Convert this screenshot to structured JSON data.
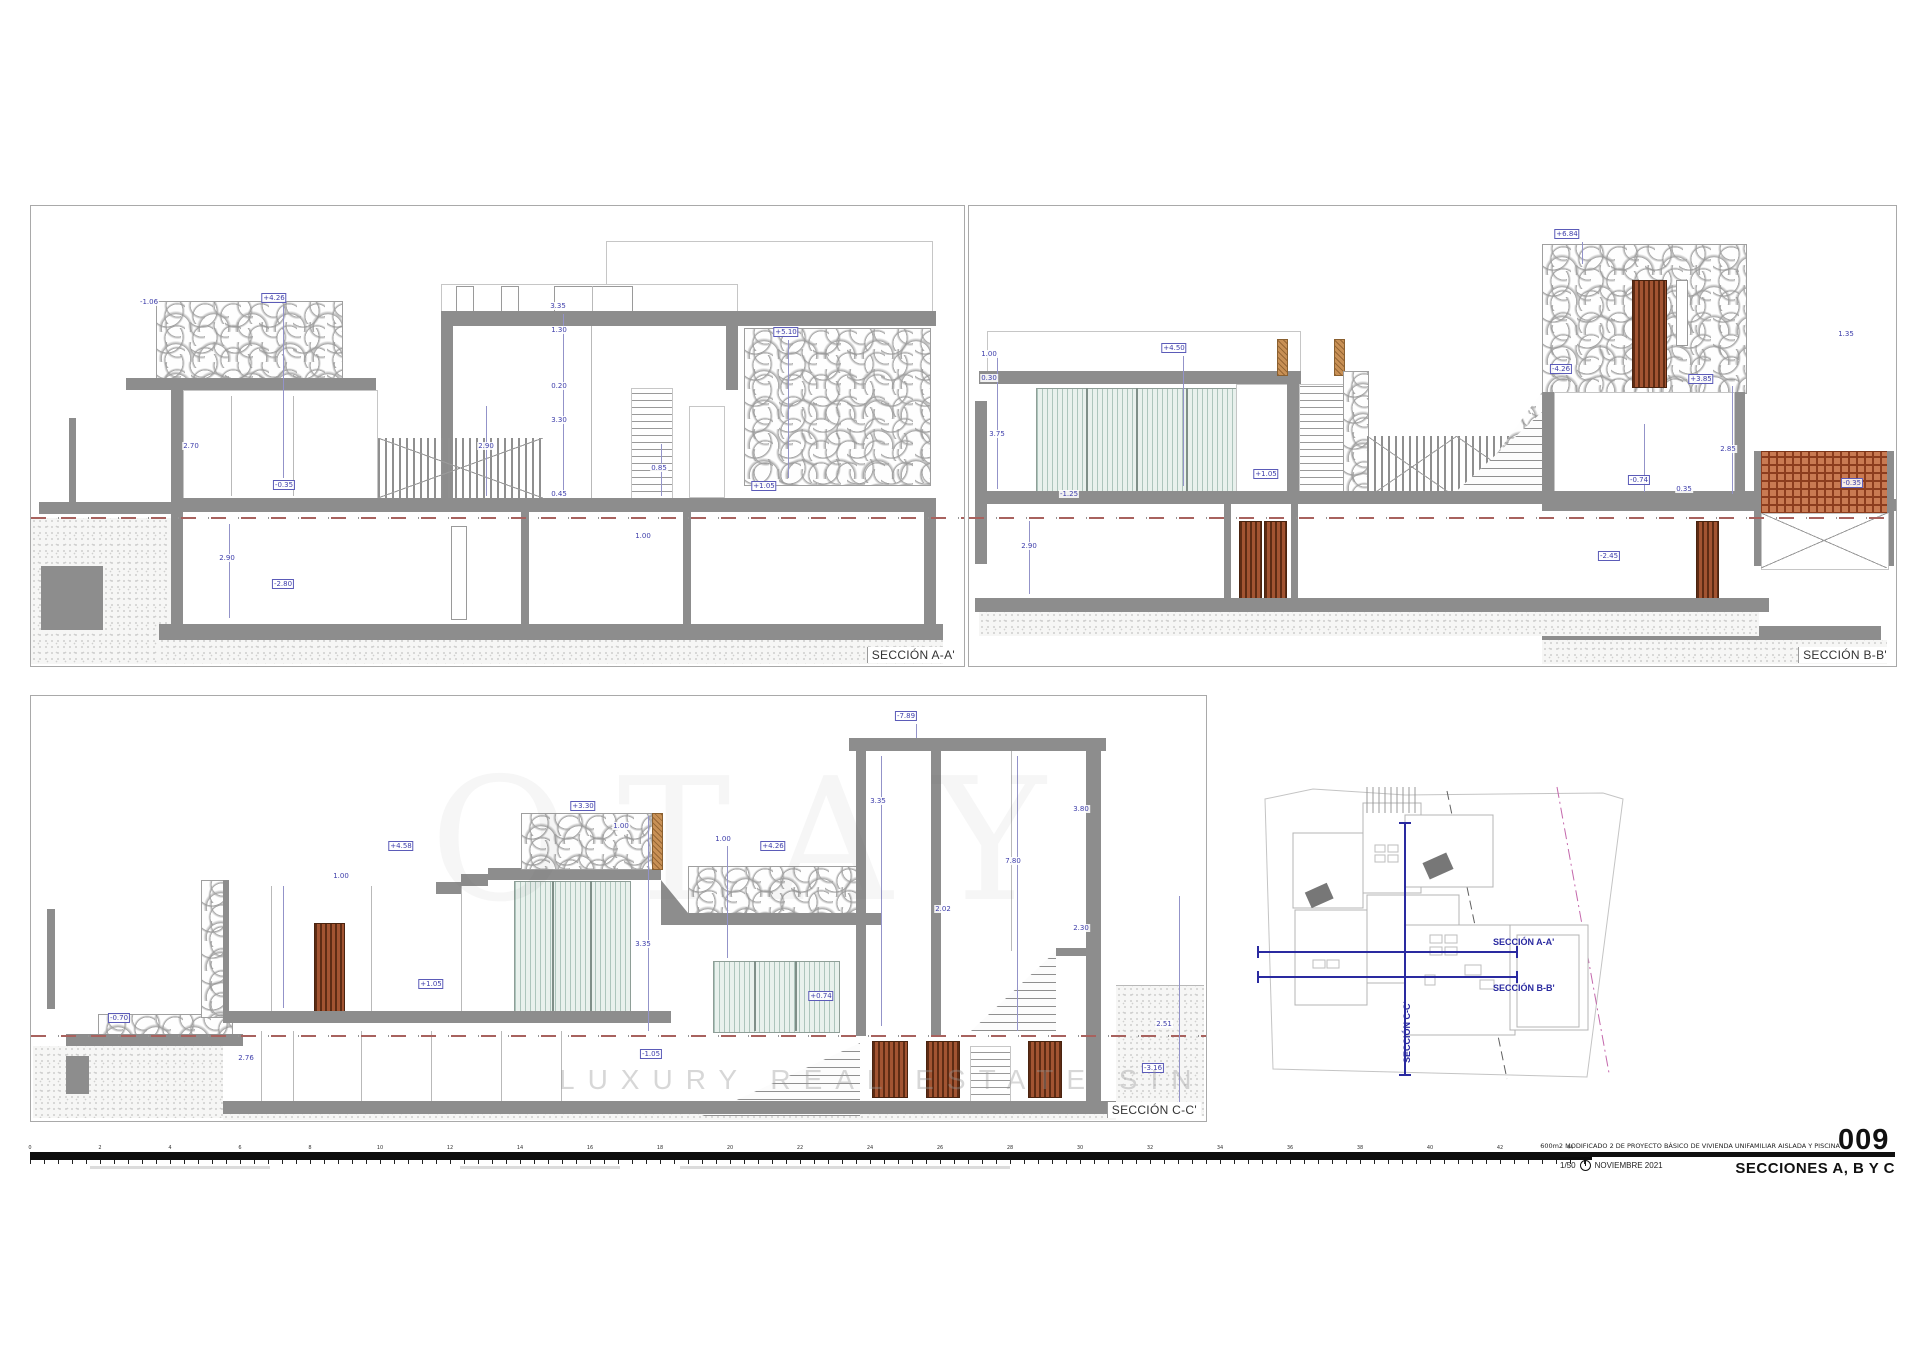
{
  "sheet": {
    "panels": [
      {
        "id": "A-A'",
        "label": "SECCIÓN A-A'"
      },
      {
        "id": "B-B'",
        "label": "SECCIÓN B-B'"
      },
      {
        "id": "C-C'",
        "label": "SECCIÓN C-C'"
      }
    ]
  },
  "siteplan": {
    "section_a_label": "SECCIÓN A-A'",
    "section_b_label": "SECCIÓN B-B'",
    "section_c_label": "SECCIÓN C-C'"
  },
  "titleblock": {
    "project": "600m2   MODIFICADO 2 DE PROYECTO BÁSICO DE VIVIENDA UNIFAMILIAR AISLADA Y PISCINA",
    "sheet_number": "009",
    "scale": "1/50",
    "date": "NOVIEMBRE 2021",
    "sheet_name": "SECCIONES A, B Y C"
  },
  "watermark": {
    "large": "OTAY",
    "small": "LUXURY REAL ESTATE SINCE"
  },
  "ruler": {
    "labels": [
      "0",
      "2",
      "4",
      "6",
      "8",
      "10",
      "12",
      "14",
      "16",
      "18",
      "20",
      "22",
      "24",
      "26",
      "28",
      "30",
      "32",
      "34",
      "36",
      "38",
      "40",
      "42",
      "44"
    ]
  },
  "colors": {
    "wall_gray": "#8d8d8d",
    "dimension_blue": "#3d3daa",
    "terrain_dash_red": "#a8625e",
    "wood_door_brown": "#a25432",
    "lattice_terracotta": "#c97a52",
    "glass_green": "#e9f1ed",
    "section_line_blue": "#2a2aa0",
    "plot_line_magenta": "#c468ac"
  },
  "drawing": {
    "A": {
      "dims": [
        {
          "x": 243,
          "y": 92,
          "t": "+4.26",
          "b": 1
        },
        {
          "x": 118,
          "y": 96,
          "t": "-1.06",
          "b": 0
        },
        {
          "x": 527,
          "y": 100,
          "t": "3.35",
          "b": 0
        },
        {
          "x": 528,
          "y": 124,
          "t": "1.30",
          "b": 0
        },
        {
          "x": 528,
          "y": 180,
          "t": "0.20",
          "b": 0
        },
        {
          "x": 528,
          "y": 214,
          "t": "3.30",
          "b": 0
        },
        {
          "x": 455,
          "y": 240,
          "t": "2.90",
          "b": 0
        },
        {
          "x": 528,
          "y": 288,
          "t": "0.45",
          "b": 0
        },
        {
          "x": 755,
          "y": 126,
          "t": "+5.10",
          "b": 1
        },
        {
          "x": 253,
          "y": 279,
          "t": "-0.35",
          "b": 1
        },
        {
          "x": 733,
          "y": 280,
          "t": "+1.05",
          "b": 1
        },
        {
          "x": 628,
          "y": 262,
          "t": "0.85",
          "b": 0
        },
        {
          "x": 196,
          "y": 352,
          "t": "2.90",
          "b": 0
        },
        {
          "x": 252,
          "y": 378,
          "t": "-2.80",
          "b": 1
        },
        {
          "x": 612,
          "y": 330,
          "t": "1.00",
          "b": 0
        },
        {
          "x": 160,
          "y": 240,
          "t": "2.70",
          "b": 0
        }
      ],
      "vlines": [
        [
          252,
          100,
          272
        ],
        [
          532,
          108,
          285
        ],
        [
          198,
          318,
          412
        ],
        [
          757,
          134,
          272
        ],
        [
          630,
          238,
          290
        ],
        [
          455,
          200,
          290
        ]
      ]
    },
    "B": {
      "dims": [
        {
          "x": 20,
          "y": 148,
          "t": "1.00",
          "b": 0
        },
        {
          "x": 20,
          "y": 172,
          "t": "0.30",
          "b": 0
        },
        {
          "x": 28,
          "y": 228,
          "t": "3.75",
          "b": 0
        },
        {
          "x": 100,
          "y": 288,
          "t": "-1.25",
          "b": 0
        },
        {
          "x": 205,
          "y": 142,
          "t": "+4.50",
          "b": 1
        },
        {
          "x": 297,
          "y": 268,
          "t": "+1.05",
          "b": 1
        },
        {
          "x": 883,
          "y": 277,
          "t": "-0.35",
          "b": 1
        },
        {
          "x": 598,
          "y": 28,
          "t": "+6.84",
          "b": 1
        },
        {
          "x": 592,
          "y": 163,
          "t": "-4.26",
          "b": 1
        },
        {
          "x": 732,
          "y": 173,
          "t": "+3.85",
          "b": 1
        },
        {
          "x": 759,
          "y": 243,
          "t": "2.85",
          "b": 0
        },
        {
          "x": 670,
          "y": 274,
          "t": "-0.74",
          "b": 1
        },
        {
          "x": 715,
          "y": 283,
          "t": "0.35",
          "b": 0
        },
        {
          "x": 640,
          "y": 350,
          "t": "-2.45",
          "b": 1
        },
        {
          "x": 60,
          "y": 340,
          "t": "2.90",
          "b": 0
        },
        {
          "x": 877,
          "y": 128,
          "t": "1.35",
          "b": 0
        }
      ],
      "vlines": [
        [
          214,
          150,
          280
        ],
        [
          28,
          150,
          283
        ],
        [
          763,
          180,
          288
        ],
        [
          675,
          218,
          286
        ],
        [
          60,
          315,
          388
        ],
        [
          613,
          36,
          58
        ]
      ]
    },
    "C": {
      "dims": [
        {
          "x": 875,
          "y": 20,
          "t": "-7.89",
          "b": 1
        },
        {
          "x": 847,
          "y": 105,
          "t": "3.35",
          "b": 0
        },
        {
          "x": 982,
          "y": 165,
          "t": "7.80",
          "b": 0
        },
        {
          "x": 1050,
          "y": 113,
          "t": "3.80",
          "b": 0
        },
        {
          "x": 1050,
          "y": 232,
          "t": "2.30",
          "b": 0
        },
        {
          "x": 912,
          "y": 213,
          "t": "2.02",
          "b": 0
        },
        {
          "x": 552,
          "y": 110,
          "t": "+3.30",
          "b": 1
        },
        {
          "x": 590,
          "y": 130,
          "t": "1.00",
          "b": 0
        },
        {
          "x": 692,
          "y": 143,
          "t": "1.00",
          "b": 0
        },
        {
          "x": 742,
          "y": 150,
          "t": "+4.26",
          "b": 1
        },
        {
          "x": 370,
          "y": 150,
          "t": "+4.58",
          "b": 1
        },
        {
          "x": 88,
          "y": 322,
          "t": "-0.70",
          "b": 1
        },
        {
          "x": 400,
          "y": 288,
          "t": "+1.05",
          "b": 1
        },
        {
          "x": 620,
          "y": 358,
          "t": "-1.05",
          "b": 1
        },
        {
          "x": 790,
          "y": 300,
          "t": "+0.74",
          "b": 1
        },
        {
          "x": 215,
          "y": 362,
          "t": "2.76",
          "b": 0
        },
        {
          "x": 612,
          "y": 248,
          "t": "3.35",
          "b": 0
        },
        {
          "x": 1133,
          "y": 328,
          "t": "2.51",
          "b": 0
        },
        {
          "x": 1122,
          "y": 372,
          "t": "-3.16",
          "b": 1
        },
        {
          "x": 310,
          "y": 180,
          "t": "1.00",
          "b": 0
        }
      ],
      "vlines": [
        [
          850,
          60,
          330
        ],
        [
          986,
          60,
          335
        ],
        [
          1148,
          200,
          415
        ],
        [
          617,
          120,
          335
        ],
        [
          696,
          150,
          262
        ],
        [
          252,
          190,
          312
        ],
        [
          885,
          28,
          42
        ]
      ]
    }
  }
}
